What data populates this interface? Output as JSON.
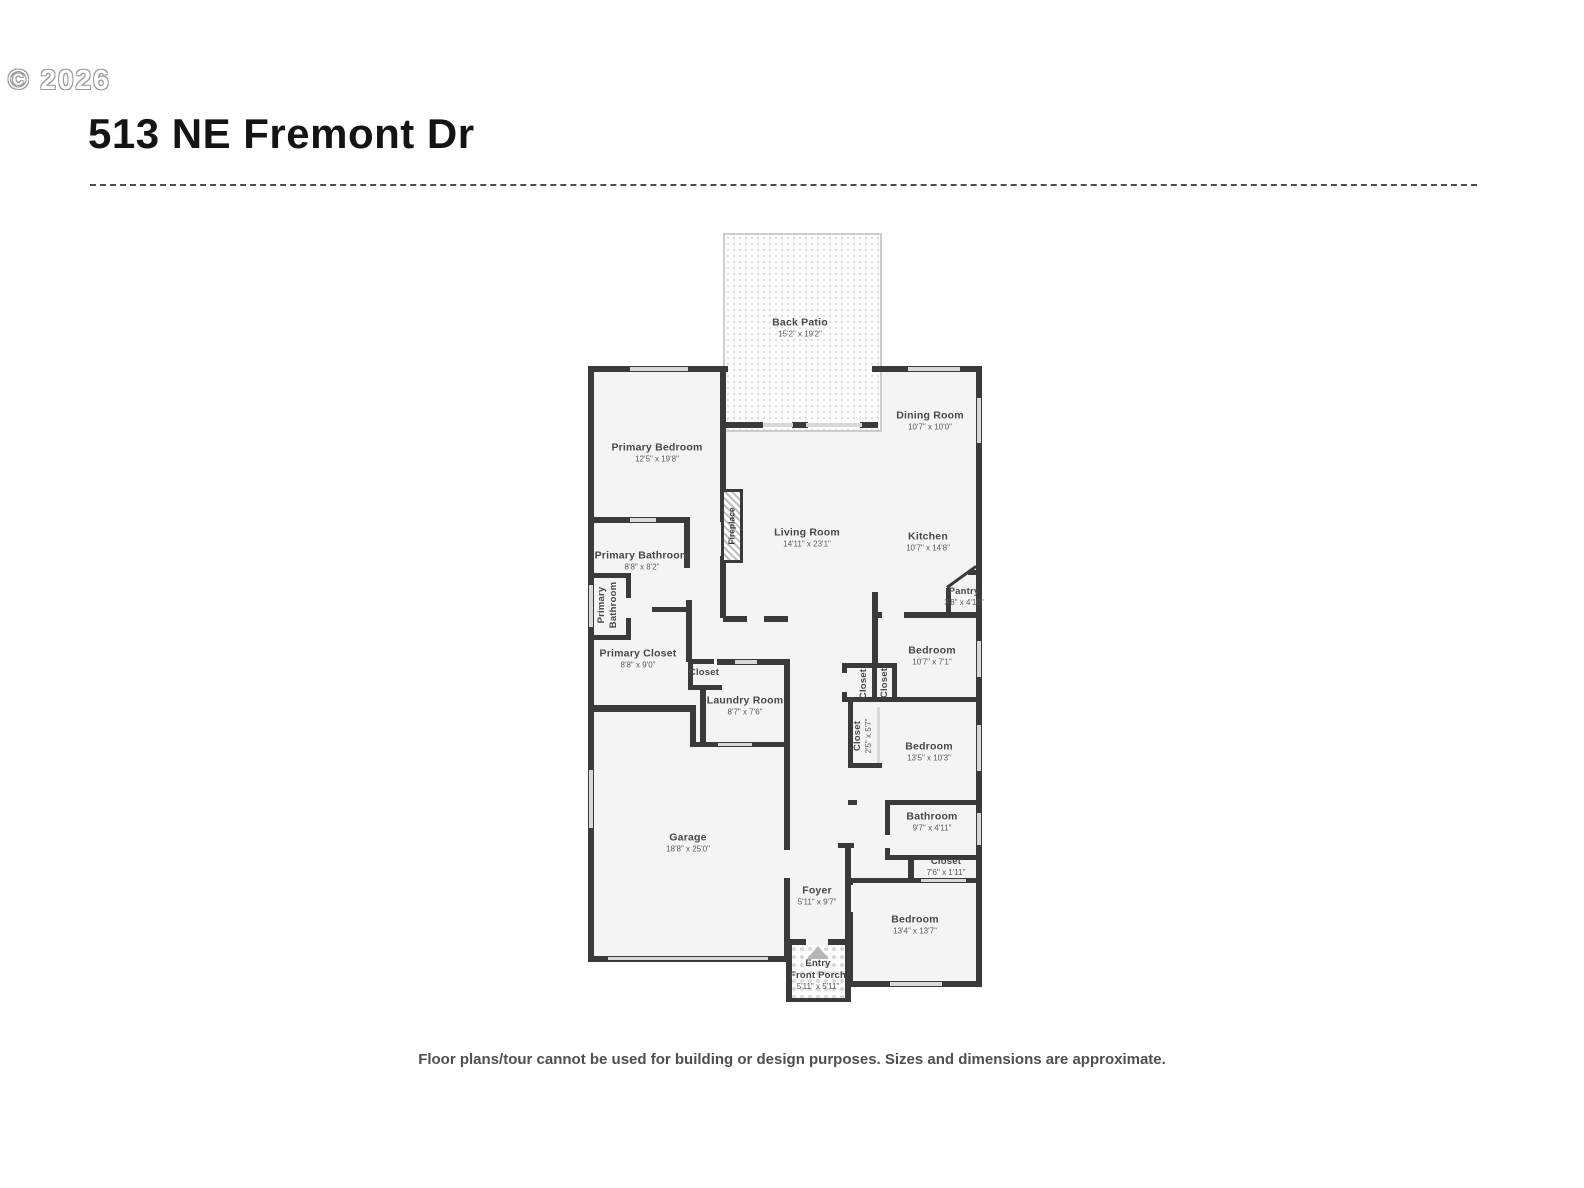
{
  "header": {
    "copyright": "© 2026",
    "title": "513 NE Fremont Dr"
  },
  "footer": {
    "disclaimer": "Floor plans/tour cannot be used for building or design purposes. Sizes and dimensions are approximate."
  },
  "rooms": {
    "back_patio": {
      "name": "Back Patio",
      "dims": "15'2\" x 19'2\""
    },
    "primary_bedroom": {
      "name": "Primary Bedroom",
      "dims": "12'5\" x 19'8\""
    },
    "dining_room": {
      "name": "Dining Room",
      "dims": "10'7\" x 10'0\""
    },
    "living_room": {
      "name": "Living Room",
      "dims": "14'11\" x 23'1\""
    },
    "kitchen": {
      "name": "Kitchen",
      "dims": "10'7\" x 14'8\""
    },
    "pantry": {
      "name": "Pantry",
      "dims": "3'8\" x 4'10\""
    },
    "primary_bathroom": {
      "name": "Primary Bathroom",
      "dims": "8'8\" x 8'2\""
    },
    "primary_bathroom_wc": {
      "line1": "Primary",
      "line2": "Bathroom"
    },
    "primary_closet": {
      "name": "Primary Closet",
      "dims": "8'8\" x 9'0\""
    },
    "hall_closet": {
      "name": "Closet"
    },
    "laundry_room": {
      "name": "Laundry Room",
      "dims": "8'7\" x 7'6\""
    },
    "bedroom_1": {
      "name": "Bedroom",
      "dims": "10'7\" x 7'1\""
    },
    "closet_a": {
      "name": "Closet"
    },
    "closet_b": {
      "name": "Closet"
    },
    "bedroom_2_closet": {
      "name": "Closet",
      "dims": "2'5\" x 5'7\""
    },
    "bedroom_2": {
      "name": "Bedroom",
      "dims": "13'5\" x 10'3\""
    },
    "bathroom": {
      "name": "Bathroom",
      "dims": "9'7\" x 4'11\""
    },
    "bathroom_closet": {
      "name": "Closet",
      "dims": "7'6\" x 1'11\""
    },
    "bedroom_3": {
      "name": "Bedroom",
      "dims": "13'4\" x 13'7\""
    },
    "garage": {
      "name": "Garage",
      "dims": "18'8\" x 25'0\""
    },
    "foyer": {
      "name": "Foyer",
      "dims": "5'11\" x 9'7\""
    },
    "fireplace": {
      "name": "Fireplace"
    },
    "entry_porch": {
      "line1": "Entry",
      "line2": "Front Porch",
      "dims": "5'11\" x 5'11\""
    }
  }
}
